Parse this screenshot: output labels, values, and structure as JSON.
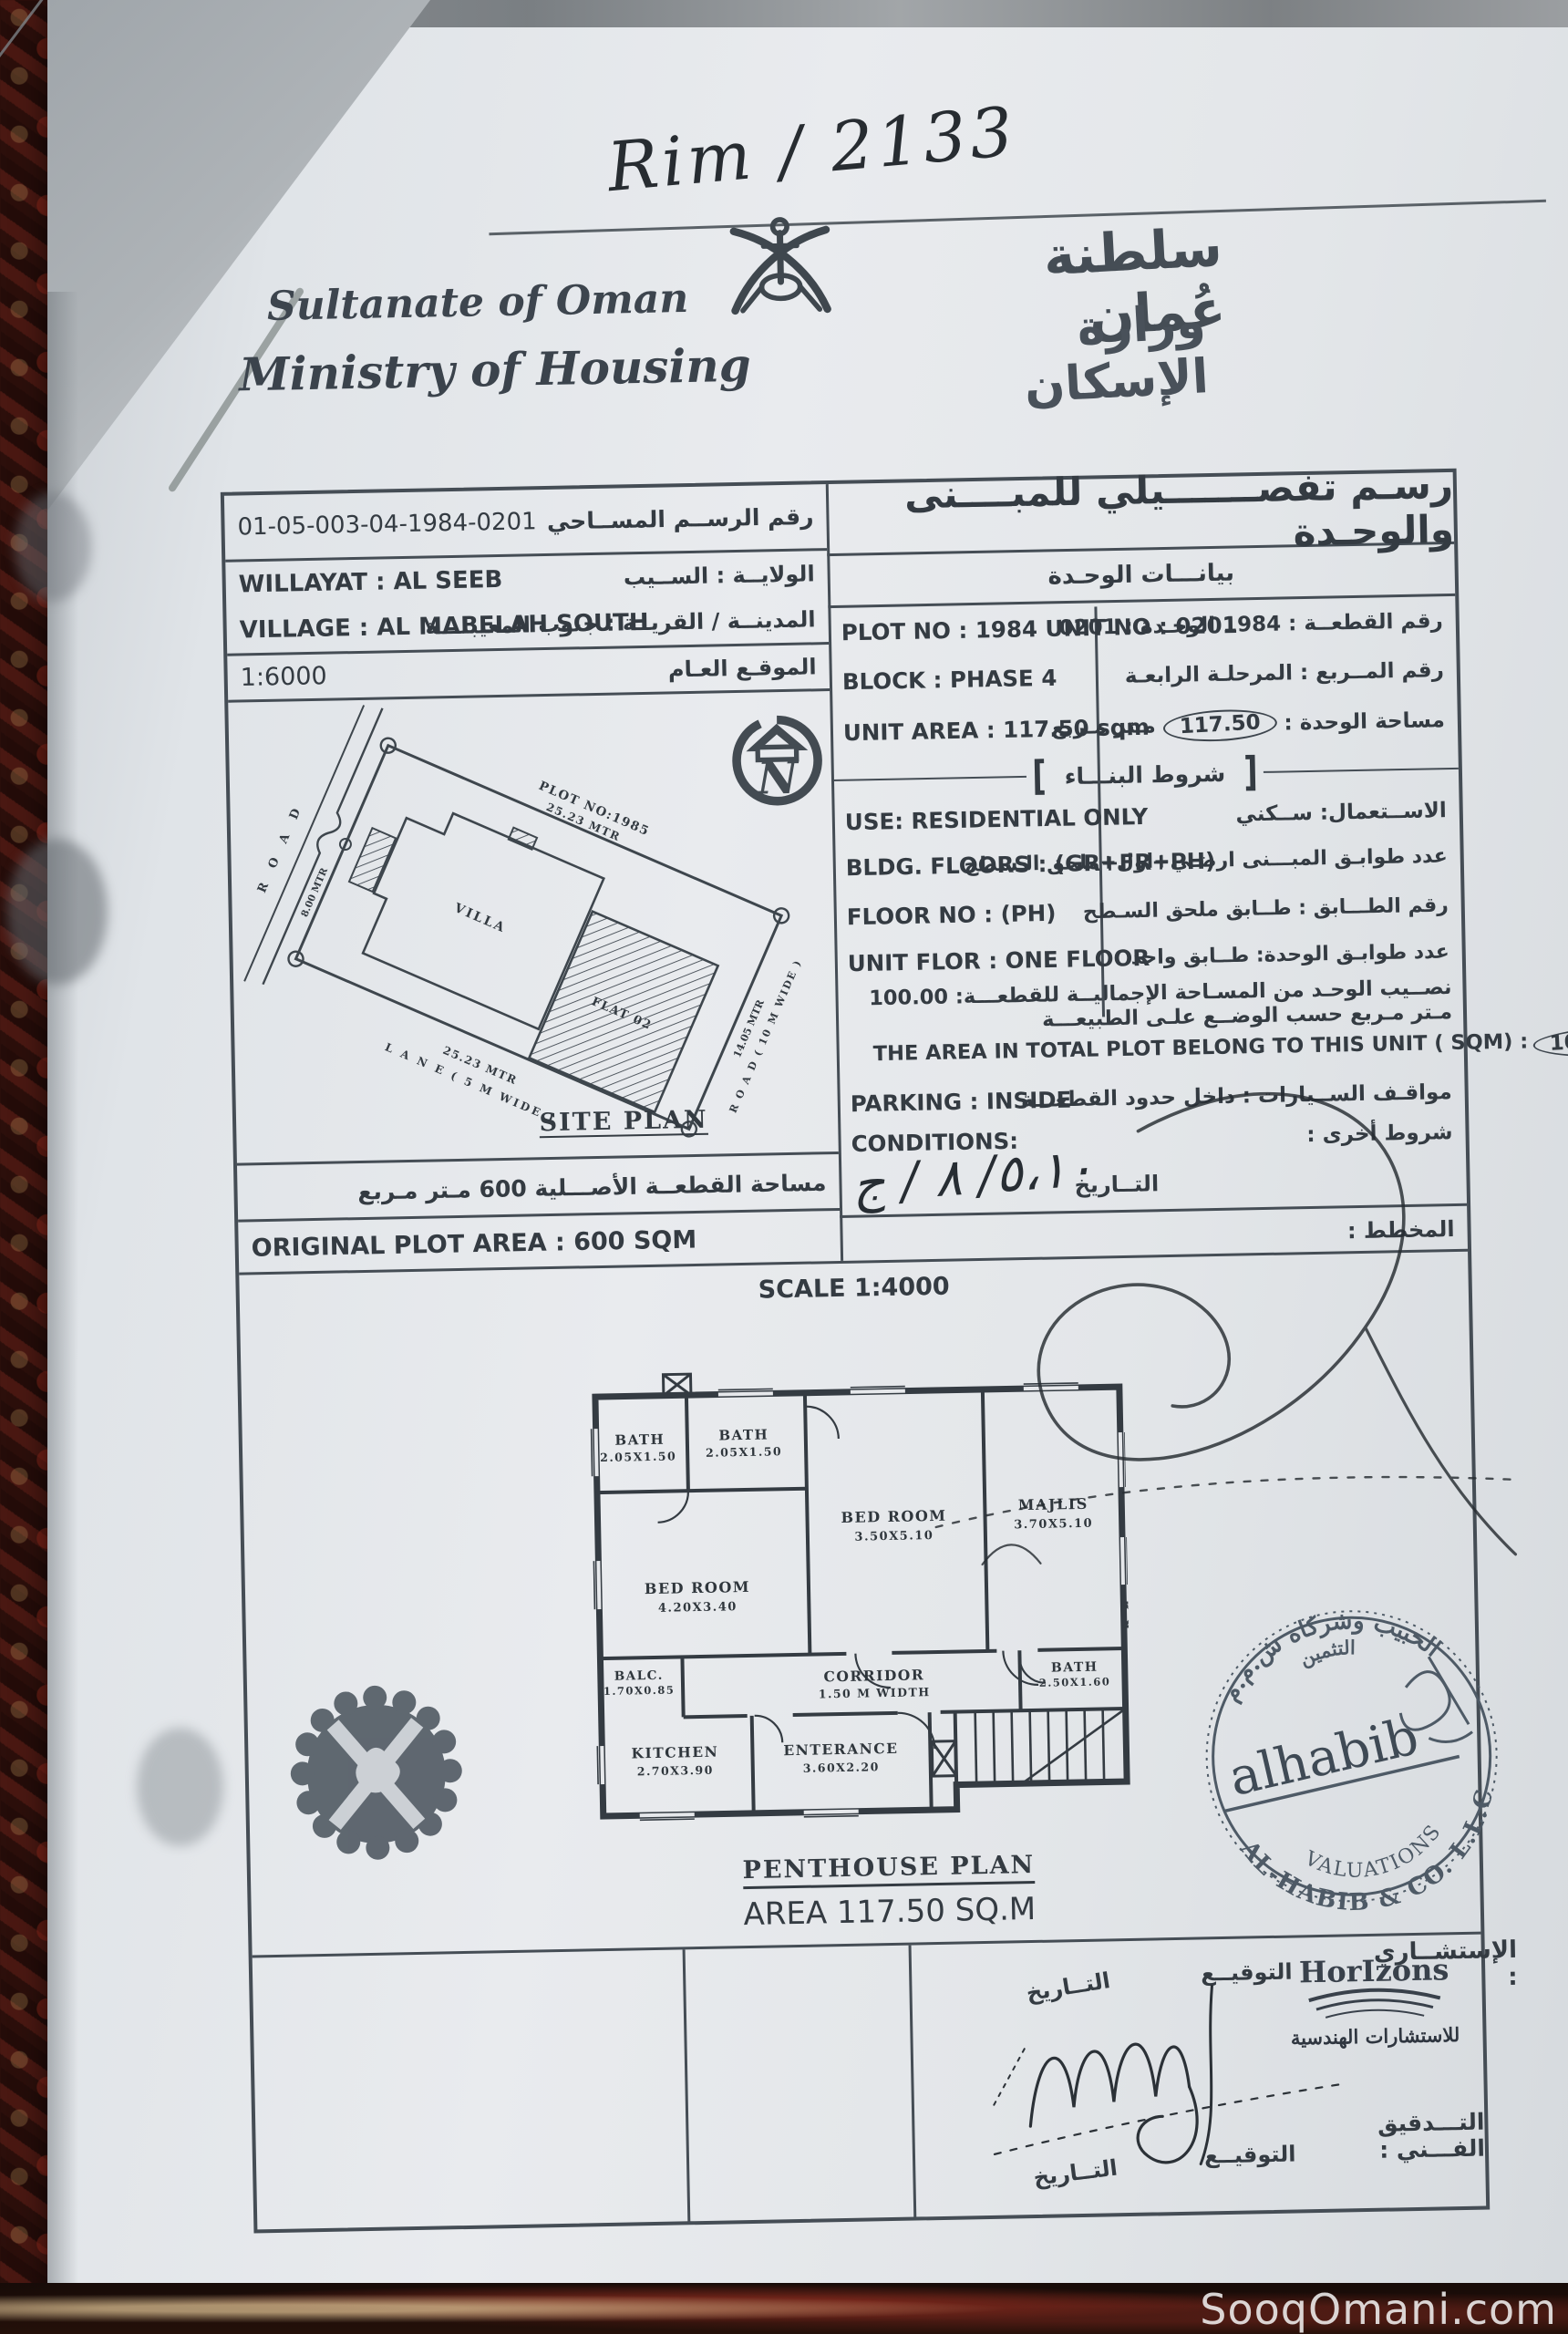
{
  "page": {
    "watermark": "SooqOmani.com"
  },
  "top": {
    "handwritten_ref": "Rim / 2133"
  },
  "header": {
    "country_en": "Sultanate of Oman",
    "ministry_en": "Ministry of Housing",
    "country_ar": "سلطنة عُمان",
    "ministry_ar": "وزارة الإسكان"
  },
  "survey": {
    "drawing_no": "01-05-003-04-1984-0201",
    "drawing_no_label_ar": "رقم الرســم المســاحي",
    "willayat_en": "WILLAYAT :     AL SEEB",
    "willayat_ar": "الولايــة :      الســيب",
    "village_en": "VILLAGE : AL MABELAH SOUTH",
    "village_ar": "المدينــة / القريــة : جنوب المعيبلـــة",
    "scale": "1:6000",
    "location_label_ar": "الموقـع العـام"
  },
  "site_plan": {
    "plot_no": "PLOT NO:1985",
    "plot_dim": "25.23 MTR",
    "villa": "VILLA",
    "flat": "FLAT 02",
    "road_left": "R O A D",
    "road_left_dim": "8.00 MTR",
    "lane_dim": "25.23 MTR",
    "lane": "L A N E ( 5 M WIDE )",
    "road_right_dim": "14.05 MTR",
    "road_right": "R O A D ( 10 M WIDE )",
    "title": "SITE PLAN",
    "orig_area_ar": "مساحة القطعــة الأصـــلية   600   مـتر مـربع",
    "orig_area_en": "ORIGINAL PLOT AREA :        600 SQM"
  },
  "unit": {
    "title_ar": "رسـم تفصـــــــيلي للمبــــنى والوحـدة",
    "subtitle_ar": "بيانـــات الوحـدة",
    "plot_en": "PLOT NO :   1984      UNIT NO :    0201",
    "plot_ar": "رقم القطعــة  :   1984      الوحـدة :  0201",
    "block_en": "BLOCK :     PHASE 4",
    "block_ar": "رقم المــربع  :   المرحلـة الرابعـة",
    "area_en": "UNIT AREA :      117.50 sqm",
    "area_ar_label": "مساحة الوحدة :",
    "area_ar_value": "117.50",
    "area_ar_unit": "مـتر مـربع",
    "conditions_title_ar": "شروط البنـــاء",
    "use_en": "USE:     RESIDENTIAL ONLY",
    "use_ar": "الاســتعمال:      ســكني",
    "floors_en": "BLDG. FLOORS :   (GR+FR+PH)",
    "floors_ar": "عدد طوابـق المبـــنى   ارضـي+اول+ملحق الـسطح",
    "floor_no_en": "FLOOR NO :          (PH)",
    "floor_no_ar": "رقم الطـــابق :       طــابق ملحق السـطح",
    "unit_floor_en": "UNIT FLOR :     ONE FLOOR",
    "unit_floor_ar": "عدد طوابـق الوحدة:       طــابق واحد",
    "share_ar": "نصــيب الوحـد من المسـاحة الإجماليــة للقطعـــة:  100.00  مـتر مـربع حسب الوضــع علـى الطبيعـــة",
    "share_en": "THE AREA IN TOTAL PLOT BELONG TO THIS UNIT ( SQM) :",
    "share_value": "100.00  SQM.",
    "parking_ar": "مواقـف الســيارات :  داخل حدود القطعـــة",
    "parking_en": "PARKING :      INSIDE",
    "other_ar": "شروط أخرى  :",
    "conditions_en": "CONDITIONS:",
    "date_label_ar": "التــاريخ",
    "date_value": "٥،١٠/ ٨ / ج",
    "planner_ar": "المخطط :"
  },
  "plan": {
    "scale": "SCALE 1:4000",
    "title": "PENTHOUSE  PLAN",
    "area": "AREA 117.50 SQ.M",
    "rooms": [
      {
        "name": "BATH",
        "dim": "2.05X1.50"
      },
      {
        "name": "BATH",
        "dim": "2.05X1.50"
      },
      {
        "name": "BED  ROOM",
        "dim": "3.50X5.10"
      },
      {
        "name": "MAJLIS",
        "dim": "3.70X5.10"
      },
      {
        "name": "BED  ROOM",
        "dim": "4.20X3.40"
      },
      {
        "name": "BALC.",
        "dim": "1.70X0.85"
      },
      {
        "name": "CORRIDOR",
        "dim": "1.50  M  WIDTH"
      },
      {
        "name": "BATH",
        "dim": "2.50X1.60"
      },
      {
        "name": "KITCHEN",
        "dim": "2.70X3.90"
      },
      {
        "name": "ENTERANCE",
        "dim": "3.60X2.20"
      }
    ]
  },
  "stamps": {
    "alhabib_top_ar": "الحبيب وشركاه ش.م.م",
    "alhabib_top2_ar": "التثمين",
    "alhabib_name": "alhabib",
    "alhabib_bottom": "AL-HABIB & CO. L.L.C",
    "alhabib_valuations": "VALUATIONS",
    "horizons_name": "HorIzons",
    "horizons_ar": "للاستشارات الهندسية"
  },
  "footer": {
    "consultant_ar": "الإستشــاري :",
    "sign_ar": "التوقيــع",
    "date_ar": "التــاريخ",
    "sign2_ar": "التوقيــع",
    "date2_ar": "التــاريخ",
    "audit_ar": "التـــدقيق الفـــني :"
  }
}
